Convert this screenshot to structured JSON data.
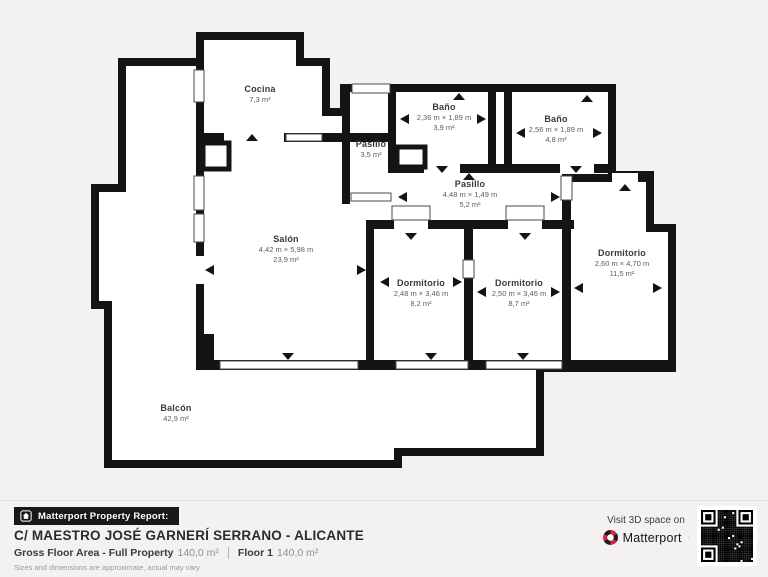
{
  "rooms": [
    {
      "name": "Cocina",
      "area": "7,3 m²"
    },
    {
      "name": "Pasillo",
      "area": "3,5 m²"
    },
    {
      "name": "Baño",
      "dims": "2,36 m × 1,89 m",
      "area": "3,9 m²"
    },
    {
      "name": "Baño",
      "dims": "2,56 m × 1,89 m",
      "area": "4,8 m²"
    },
    {
      "name": "Pasillo",
      "dims": "4,48 m × 1,49 m",
      "area": "5,2 m²"
    },
    {
      "name": "Salón",
      "dims": "4,42 m × 5,98 m",
      "area": "23,9 m²"
    },
    {
      "name": "Dormitorio",
      "dims": "2,48 m × 3,46 m",
      "area": "8,2 m²"
    },
    {
      "name": "Dormitorio",
      "dims": "2,50 m × 3,46 m",
      "area": "8,7 m²"
    },
    {
      "name": "Dormitorio",
      "dims": "2,60 m × 4,70 m",
      "area": "11,5 m²"
    },
    {
      "name": "Balcón",
      "area": "42,9 m²"
    }
  ],
  "footer": {
    "report_badge": "Matterport Property Report:",
    "address": "C/ MAESTRO JOSÉ GARNERÍ SERRANO - ALICANTE",
    "gross_label": "Gross Floor Area - Full Property",
    "gross_value": "140,0 m²",
    "floor_label": "Floor 1",
    "floor_value": "140,0 m²",
    "disclaimer": "Sizes and dimensions are approximate, actual may vary",
    "visit_text": "Visit 3D space on",
    "brand": "Matterport"
  },
  "colors": {
    "wall": "#141414",
    "room_fill": "#ffffff",
    "background": "#f3f2f0",
    "badge_bg": "#181818",
    "brand_red": "#d92344"
  }
}
